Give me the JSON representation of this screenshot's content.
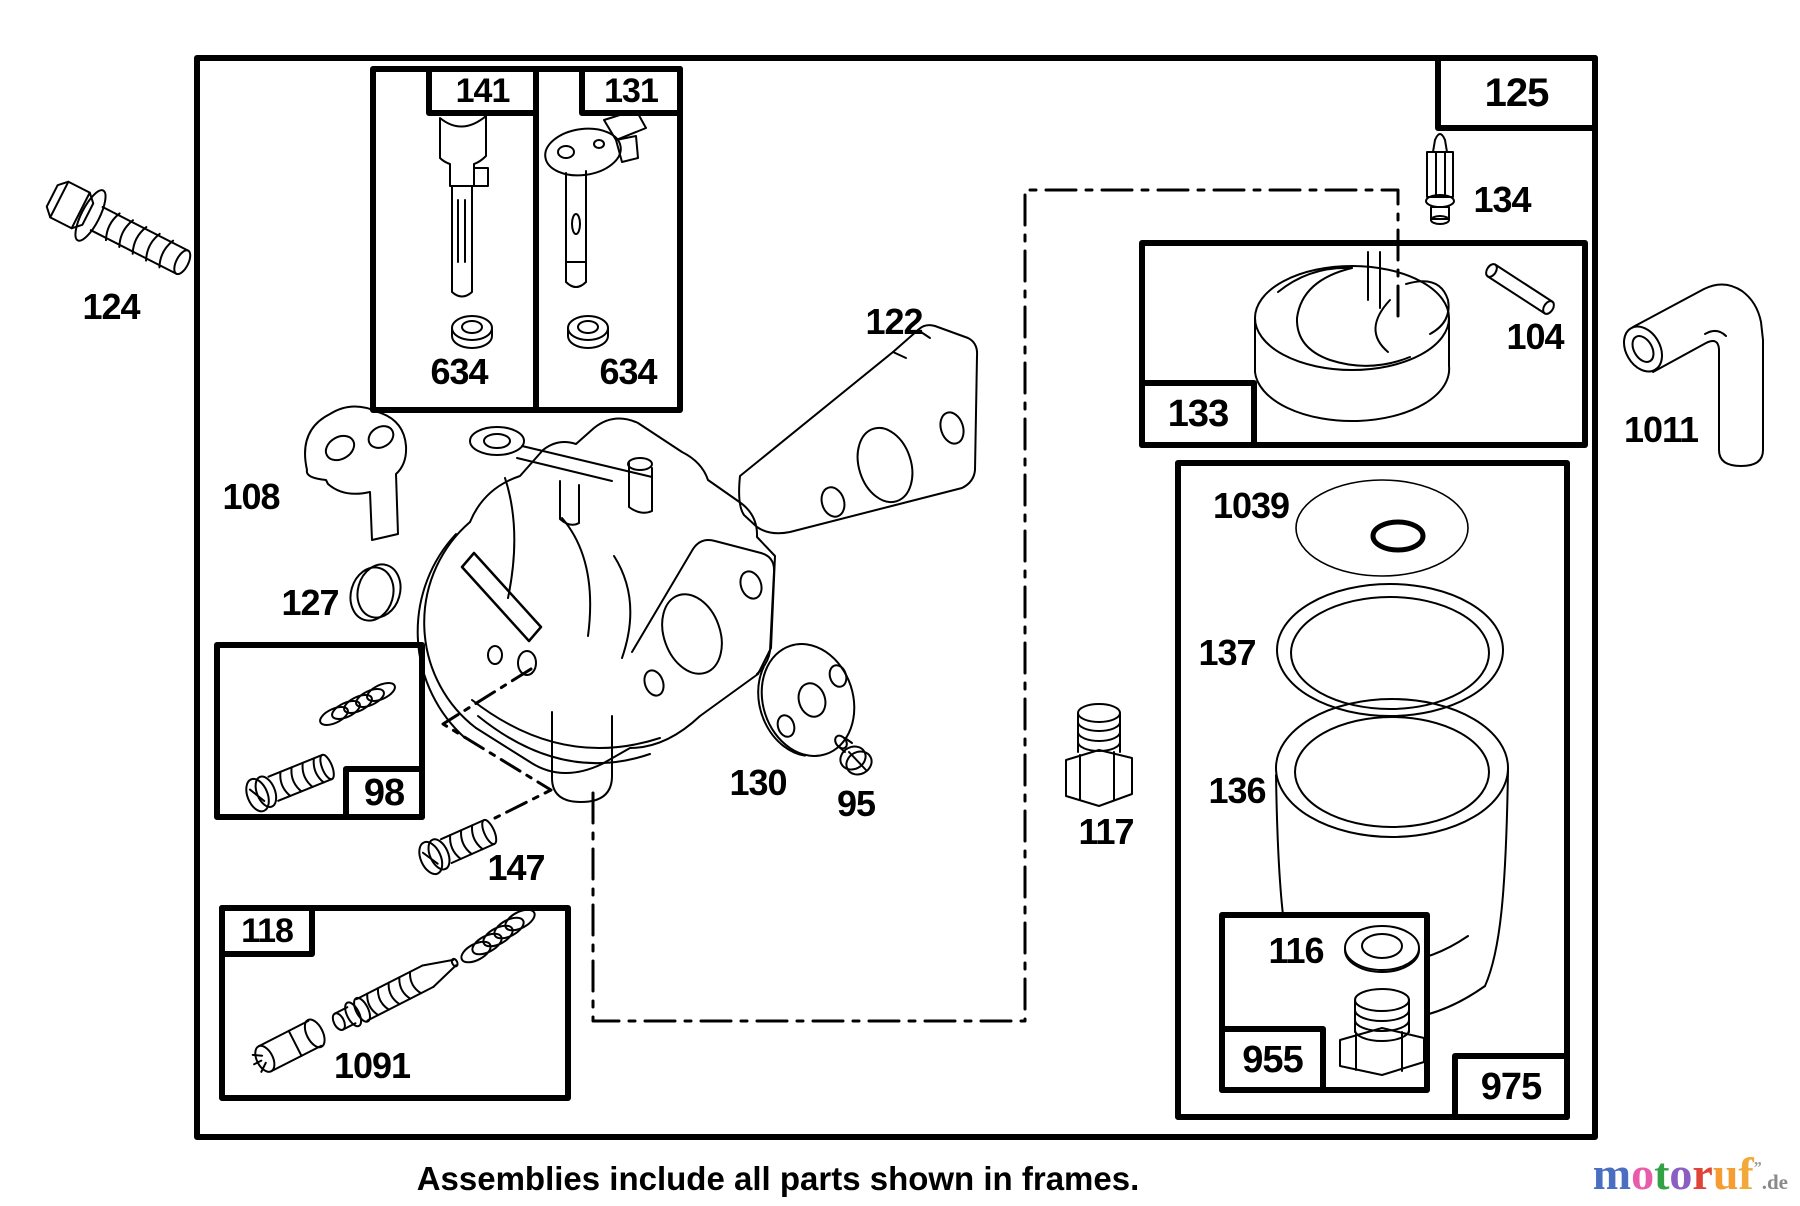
{
  "diagram": {
    "caption": "Assemblies include all parts shown in frames.",
    "colors": {
      "line": "#000000",
      "background": "#ffffff"
    },
    "part_labels": {
      "p124": "124",
      "p141": "141",
      "p131": "131",
      "p634a": "634",
      "p634b": "634",
      "p125": "125",
      "p108": "108",
      "p127": "127",
      "p122": "122",
      "p98": "98",
      "p130": "130",
      "p95": "95",
      "p147": "147",
      "p118": "118",
      "p1091": "1091",
      "p117": "117",
      "p133": "133",
      "p134": "134",
      "p104": "104",
      "p1011": "1011",
      "p1039": "1039",
      "p137": "137",
      "p136": "136",
      "p116": "116",
      "p955": "955",
      "p975": "975"
    }
  },
  "logo": {
    "letters": [
      {
        "char": "m",
        "color": "#4a6fc0"
      },
      {
        "char": "o",
        "color": "#e85caa"
      },
      {
        "char": "t",
        "color": "#33a146"
      },
      {
        "char": "o",
        "color": "#8a5ec2"
      },
      {
        "char": "r",
        "color": "#e04438"
      },
      {
        "char": "u",
        "color": "#f59d33"
      },
      {
        "char": "f",
        "color": "#f2a93b"
      }
    ],
    "mark": "”",
    "suffix": ".de"
  }
}
